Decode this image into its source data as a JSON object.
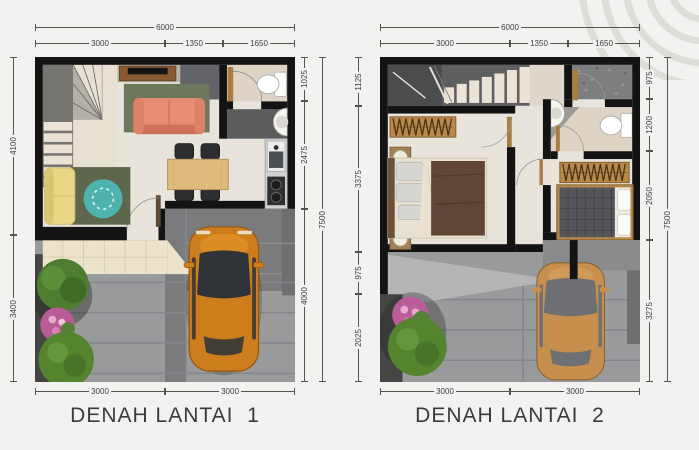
{
  "plans": [
    {
      "title": "DENAH LANTAI  1",
      "dims": {
        "top_total": "6000",
        "top": [
          "3000",
          "1350",
          "1650"
        ],
        "left": [
          "4100",
          "3400"
        ],
        "right": [
          "1025",
          "2475",
          "4000"
        ],
        "side_total": "7500",
        "bottom": [
          "3000",
          "3000"
        ]
      }
    },
    {
      "title": "DENAH LANTAI  2",
      "dims": {
        "top_total": "6000",
        "top": [
          "3000",
          "1350",
          "1650"
        ],
        "left": [
          "1125",
          "3375",
          "975",
          "2025"
        ],
        "right": [
          "975",
          "1200",
          "2050",
          "3275"
        ],
        "side_total": "7500",
        "bottom": [
          "3000",
          "3000"
        ]
      }
    }
  ],
  "colors": {
    "background": "#f3f2f0",
    "wall": "#131313",
    "floor": "#e9e4db",
    "car_body": "#ce7d1d",
    "ghost_car_body": "#c78f4e",
    "sofa_salmon": "#e78e74",
    "sofa_yellow": "#ead786",
    "rug_olive": "#6e785c",
    "rug_teal": "#4db3ac",
    "table_wood": "#debb7c",
    "wardrobe_wood": "#b9894a",
    "blanket_brown": "#5f4636",
    "paving_gray": "#999a9c",
    "dim_text": "#3f3f3d"
  }
}
